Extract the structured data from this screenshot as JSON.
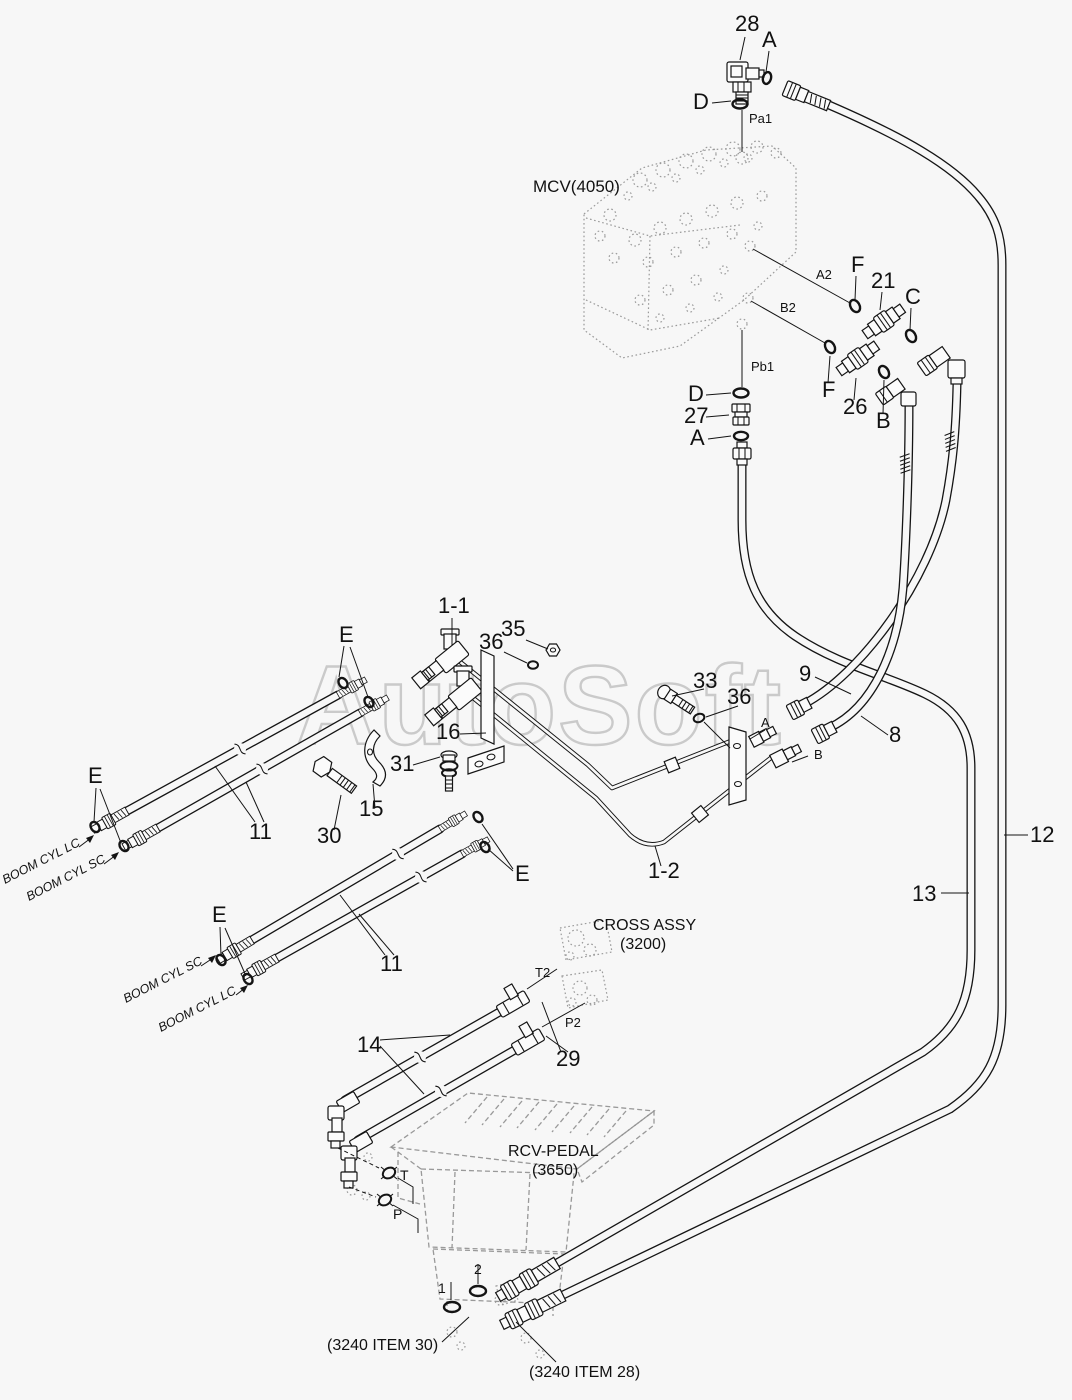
{
  "diagram": {
    "type": "hydraulic-piping-parts-diagram",
    "assemblies": [
      "MCV(4050)",
      "CROSS ASSY (3200)",
      "RCV-PEDAL (3650)"
    ],
    "part_numbers": [
      "1-1",
      "1-2",
      "8",
      "9",
      "11",
      "12",
      "13",
      "14",
      "15",
      "16",
      "21",
      "26",
      "27",
      "28",
      "29",
      "30",
      "31",
      "33",
      "35",
      "36"
    ],
    "seal_refs": [
      "A",
      "B",
      "C",
      "D",
      "E",
      "F",
      "1",
      "2"
    ],
    "port_refs": [
      "Pa1",
      "Pb1",
      "A2",
      "B2",
      "T2",
      "P2",
      "T",
      "P",
      "A",
      "B"
    ],
    "external_refs": [
      "(3240 ITEM 30)",
      "(3240 ITEM 28)"
    ],
    "line_labels": [
      "BOOM CYL LC",
      "BOOM CYL SC"
    ]
  },
  "colors": {
    "background": "#f7f7f7",
    "line": "#141414",
    "ghost": "#959595",
    "watermark": "#c3c3c3"
  },
  "watermark_text": "AutoSoft",
  "labels": [
    {
      "name": "part-28",
      "text": "28",
      "x": 735,
      "y": 31,
      "size": 22
    },
    {
      "name": "oring-a-top",
      "text": "A",
      "x": 762,
      "y": 47,
      "size": 22
    },
    {
      "name": "oring-d-top",
      "text": "D",
      "x": 693,
      "y": 109,
      "size": 22
    },
    {
      "name": "port-pa1",
      "text": "Pa1",
      "x": 749,
      "y": 123,
      "size": 13
    },
    {
      "name": "mcv-assy",
      "text": "MCV(4050)",
      "x": 533,
      "y": 192,
      "size": 17
    },
    {
      "name": "port-a2",
      "text": "A2",
      "x": 816,
      "y": 279,
      "size": 13
    },
    {
      "name": "oring-f1",
      "text": "F",
      "x": 851,
      "y": 272,
      "size": 22
    },
    {
      "name": "part-21",
      "text": "21",
      "x": 871,
      "y": 288,
      "size": 22
    },
    {
      "name": "oring-c",
      "text": "C",
      "x": 905,
      "y": 304,
      "size": 22
    },
    {
      "name": "port-b2",
      "text": "B2",
      "x": 780,
      "y": 312,
      "size": 13
    },
    {
      "name": "oring-f2",
      "text": "F",
      "x": 822,
      "y": 397,
      "size": 22
    },
    {
      "name": "part-26",
      "text": "26",
      "x": 843,
      "y": 414,
      "size": 22
    },
    {
      "name": "oring-b",
      "text": "B",
      "x": 876,
      "y": 428,
      "size": 22
    },
    {
      "name": "oring-d2",
      "text": "D",
      "x": 688,
      "y": 401,
      "size": 22
    },
    {
      "name": "part-27",
      "text": "27",
      "x": 684,
      "y": 423,
      "size": 22
    },
    {
      "name": "oring-a2",
      "text": "A",
      "x": 690,
      "y": 445,
      "size": 22
    },
    {
      "name": "port-pb1",
      "text": "Pb1",
      "x": 751,
      "y": 371,
      "size": 13
    },
    {
      "name": "asm-1-1",
      "text": "1-1",
      "x": 438,
      "y": 613,
      "size": 22
    },
    {
      "name": "oring-e1",
      "text": "E",
      "x": 339,
      "y": 642,
      "size": 22
    },
    {
      "name": "part-35",
      "text": "35",
      "x": 501,
      "y": 636,
      "size": 22
    },
    {
      "name": "part-36a",
      "text": "36",
      "x": 479,
      "y": 649,
      "size": 22
    },
    {
      "name": "part-16",
      "text": "16",
      "x": 436,
      "y": 739,
      "size": 22
    },
    {
      "name": "part-31",
      "text": "31",
      "x": 390,
      "y": 771,
      "size": 22
    },
    {
      "name": "part-15",
      "text": "15",
      "x": 359,
      "y": 816,
      "size": 22
    },
    {
      "name": "part-30",
      "text": "30",
      "x": 317,
      "y": 843,
      "size": 22
    },
    {
      "name": "part-33",
      "text": "33",
      "x": 693,
      "y": 688,
      "size": 22
    },
    {
      "name": "part-36b",
      "text": "36",
      "x": 727,
      "y": 704,
      "size": 22
    },
    {
      "name": "part-9",
      "text": "9",
      "x": 799,
      "y": 681,
      "size": 22
    },
    {
      "name": "part-8",
      "text": "8",
      "x": 889,
      "y": 742,
      "size": 22
    },
    {
      "name": "port-a-bracket",
      "text": "A",
      "x": 761,
      "y": 727,
      "size": 13
    },
    {
      "name": "port-b-bracket",
      "text": "B",
      "x": 814,
      "y": 759,
      "size": 13
    },
    {
      "name": "asm-1-2",
      "text": "1-2",
      "x": 648,
      "y": 878,
      "size": 22
    },
    {
      "name": "part-12",
      "text": "12",
      "x": 1030,
      "y": 842,
      "size": 22
    },
    {
      "name": "part-13",
      "text": "13",
      "x": 912,
      "y": 901,
      "size": 22
    },
    {
      "name": "oring-e2",
      "text": "E",
      "x": 88,
      "y": 783,
      "size": 22
    },
    {
      "name": "boom-cyl-lc-1",
      "text": "BOOM CYL LC",
      "x": 5,
      "y": 884,
      "size": 12.5,
      "rotate": -27,
      "cls": "it"
    },
    {
      "name": "boom-cyl-sc-1",
      "text": "BOOM CYL SC",
      "x": 29,
      "y": 901,
      "size": 12.5,
      "rotate": -27,
      "cls": "it"
    },
    {
      "name": "part-11a",
      "text": "11",
      "x": 249,
      "y": 839,
      "size": 22
    },
    {
      "name": "oring-e3",
      "text": "E",
      "x": 212,
      "y": 922,
      "size": 22
    },
    {
      "name": "boom-cyl-sc-2",
      "text": "BOOM CYL SC",
      "x": 126,
      "y": 1003,
      "size": 12.5,
      "rotate": -27,
      "cls": "it"
    },
    {
      "name": "boom-cyl-lc-2",
      "text": "BOOM CYL LC",
      "x": 161,
      "y": 1032,
      "size": 12.5,
      "rotate": -27,
      "cls": "it"
    },
    {
      "name": "part-11b",
      "text": "11",
      "x": 380,
      "y": 971,
      "size": 22
    },
    {
      "name": "oring-e4",
      "text": "E",
      "x": 515,
      "y": 881,
      "size": 22
    },
    {
      "name": "cross-assy-name",
      "text": "CROSS ASSY",
      "x": 593,
      "y": 930,
      "size": 16
    },
    {
      "name": "cross-assy-number",
      "text": "(3200)",
      "x": 620,
      "y": 949,
      "size": 16
    },
    {
      "name": "port-t2",
      "text": "T2",
      "x": 535,
      "y": 977,
      "size": 13
    },
    {
      "name": "port-p2",
      "text": "P2",
      "x": 565,
      "y": 1027,
      "size": 13
    },
    {
      "name": "part-29",
      "text": "29",
      "x": 556,
      "y": 1066,
      "size": 22
    },
    {
      "name": "part-14",
      "text": "14",
      "x": 357,
      "y": 1052,
      "size": 22
    },
    {
      "name": "rcv-pedal-name",
      "text": "RCV-PEDAL",
      "x": 508,
      "y": 1156,
      "size": 16
    },
    {
      "name": "rcv-pedal-number",
      "text": "(3650)",
      "x": 532,
      "y": 1175,
      "size": 16
    },
    {
      "name": "port-t",
      "text": "T",
      "x": 400,
      "y": 1180,
      "size": 14
    },
    {
      "name": "port-p",
      "text": "P",
      "x": 393,
      "y": 1219,
      "size": 14
    },
    {
      "name": "num-1",
      "text": "1",
      "x": 438,
      "y": 1293,
      "size": 14
    },
    {
      "name": "num-2",
      "text": "2",
      "x": 474,
      "y": 1274,
      "size": 14
    },
    {
      "name": "ref-item-30",
      "text": "(3240 ITEM 30)",
      "x": 327,
      "y": 1350,
      "size": 16
    },
    {
      "name": "ref-item-28",
      "text": "(3240 ITEM 28)",
      "x": 529,
      "y": 1377,
      "size": 16
    },
    {
      "name": "watermark",
      "text": "AutoSoft",
      "x": 296,
      "y": 744,
      "size": 112,
      "cls": "wm",
      "textLength": 487
    }
  ]
}
